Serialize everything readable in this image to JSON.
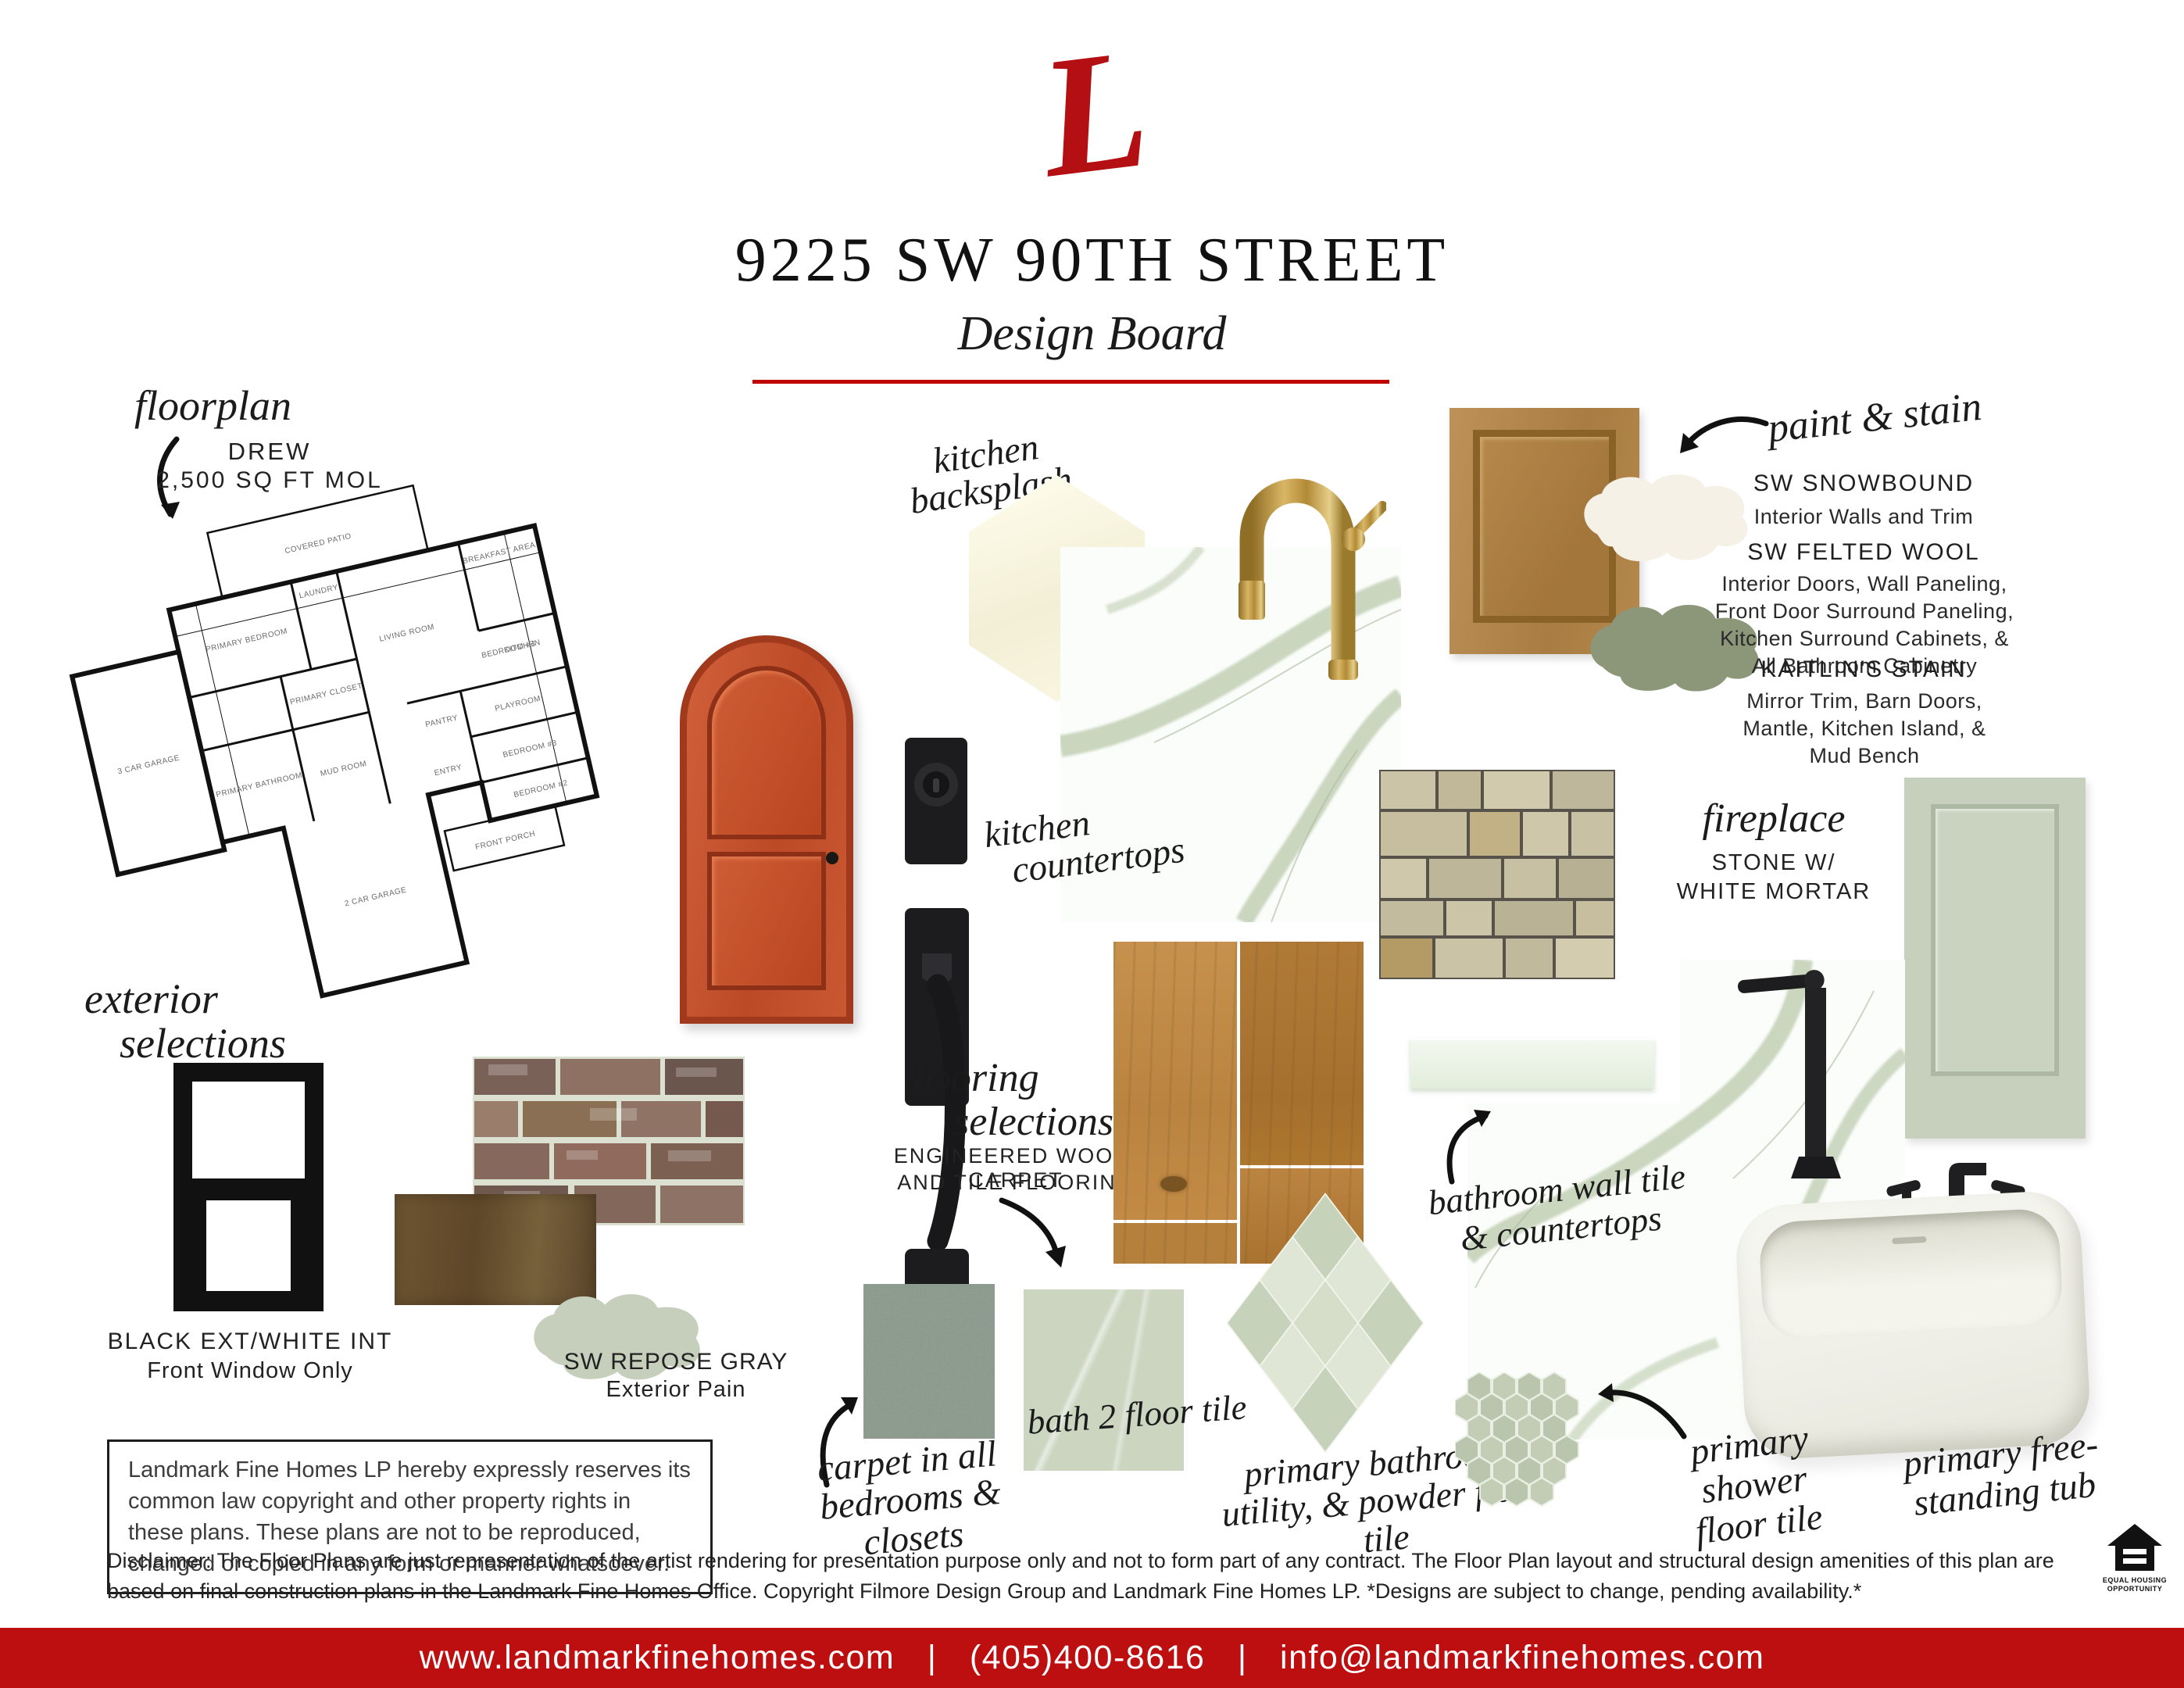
{
  "colors": {
    "accent_red": "#B40F12",
    "footer_red": "#BD0E10",
    "divider_red": "#C00000",
    "sage_stain": "#8C9678",
    "cream_paint": "#F6F1E7",
    "repose_gray": "#C5CFBB",
    "mint_tile": "#E9F1E3"
  },
  "header": {
    "logo_letter": "L",
    "title": "9225 SW 90TH STREET",
    "subtitle": "Design Board"
  },
  "floorplan": {
    "label": "floorplan",
    "plan_name": "DREW",
    "plan_size": "2,500 SQ FT MOL",
    "rooms": [
      "COVERED PATIO",
      "BREAKFAST AREA",
      "LIVING ROOM",
      "KITCHEN",
      "PRIMARY BEDROOM",
      "PRIMARY CLOSET",
      "PRIMARY BATHROOM",
      "LAUNDRY",
      "MUD ROOM",
      "PANTRY",
      "3 CAR GARAGE",
      "2 CAR GARAGE",
      "ENTRY",
      "PLAYROOM",
      "BEDROOM #4",
      "BEDROOM #3",
      "BEDROOM #2",
      "FRONT PORCH"
    ]
  },
  "kitchen_backsplash": {
    "label_line1": "kitchen",
    "label_line2": "backsplash"
  },
  "kitchen_countertops": {
    "label_line1": "kitchen",
    "label_line2": "countertops"
  },
  "paint_stain": {
    "label": "paint & stain",
    "items": [
      {
        "name": "SW SNOWBOUND",
        "desc": "Interior Walls and Trim"
      },
      {
        "name": "SW FELTED WOOL",
        "desc": "Interior Doors, Wall Paneling, Front Door Surround Paneling, Kitchen Surround Cabinets, & All Bathroom Cabinetry"
      },
      {
        "name": "KAITLIN'S STAIN",
        "desc": "Mirror Trim, Barn Doors, Mantle, Kitchen Island, & Mud Bench"
      }
    ]
  },
  "fireplace": {
    "label": "fireplace",
    "desc_line1": "STONE W/",
    "desc_line2": "WHITE MORTAR"
  },
  "exterior": {
    "label_line1": "exterior",
    "label_line2": "selections",
    "window_name": "BLACK EXT/WHITE INT",
    "window_desc": "Front Window Only",
    "paint_name": "SW REPOSE GRAY",
    "paint_desc": "Exterior Pain"
  },
  "flooring": {
    "label_line1": "flooring",
    "label_line2": "selections",
    "desc_line1": "ENGINEERED WOOD, CARPET",
    "desc_line2": "AND TILE FLOORING"
  },
  "bathroom_wall": {
    "label_line1": "bathroom wall tile",
    "label_line2": "& countertops"
  },
  "carpet": {
    "label_line1": "carpet in all",
    "label_line2": "bedrooms & closets"
  },
  "bath2": {
    "label": "bath 2 floor tile"
  },
  "primary_floor": {
    "label_line1": "primary bathroom,",
    "label_line2": "utility, & powder floor tile"
  },
  "shower_floor": {
    "label_line1": "primary shower",
    "label_line2": "floor tile"
  },
  "tub": {
    "label_line1": "primary free-",
    "label_line2": "standing tub"
  },
  "legal": {
    "copyright": "Landmark Fine Homes LP hereby expressly reserves its common law copyright and other property rights in these plans. These plans are not to be reproduced, changed or copied in any form or manner whatsoever.",
    "disclaimer": "Disclaimer: The Floor Plans are just representation of the artist rendering for presentation purpose only and not to form part of any contract. The Floor Plan layout and structural design amenities of this plan are based on final construction plans in the Landmark Fine Homes Office. Copyright Filmore Design Group and Landmark Fine Homes LP. *Designs are subject to change, pending availability.*",
    "eho_line1": "EQUAL HOUSING",
    "eho_line2": "OPPORTUNITY"
  },
  "footer": {
    "website": "www.landmarkfinehomes.com",
    "separator": "|",
    "phone": "(405)400-8616",
    "email": "info@landmarkfinehomes.com"
  }
}
